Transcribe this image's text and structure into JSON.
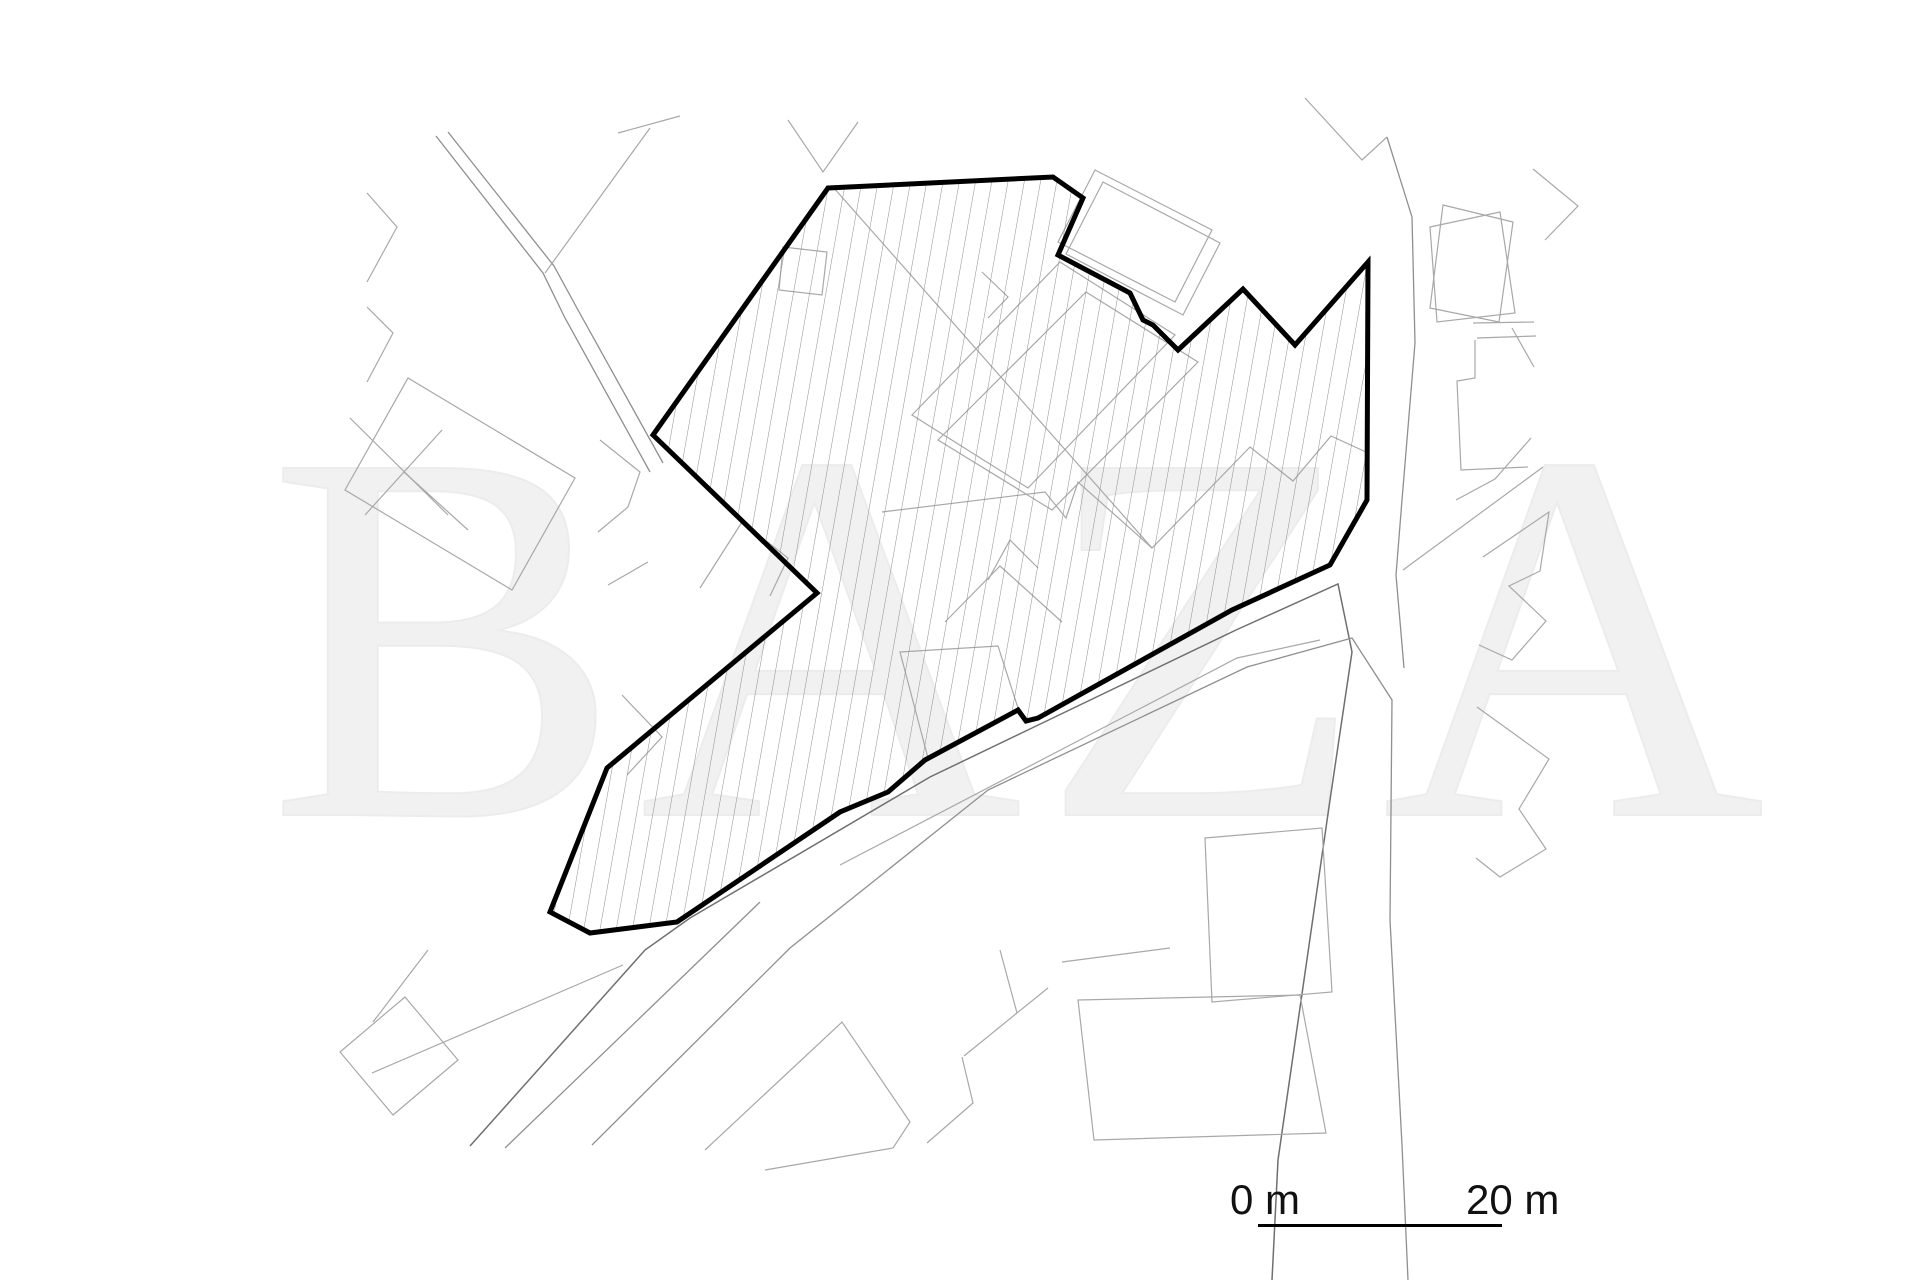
{
  "watermark": {
    "text": "BAZA"
  },
  "scale_bar": {
    "start_label": "0 m",
    "end_label": "20 m"
  },
  "colors": {
    "background": "#ffffff",
    "boundary": "#000000",
    "mapline": "#a8a8a8",
    "hatch": "#8c8c8c",
    "watermark": "#f1f1f1",
    "scaletext": "#111111"
  }
}
